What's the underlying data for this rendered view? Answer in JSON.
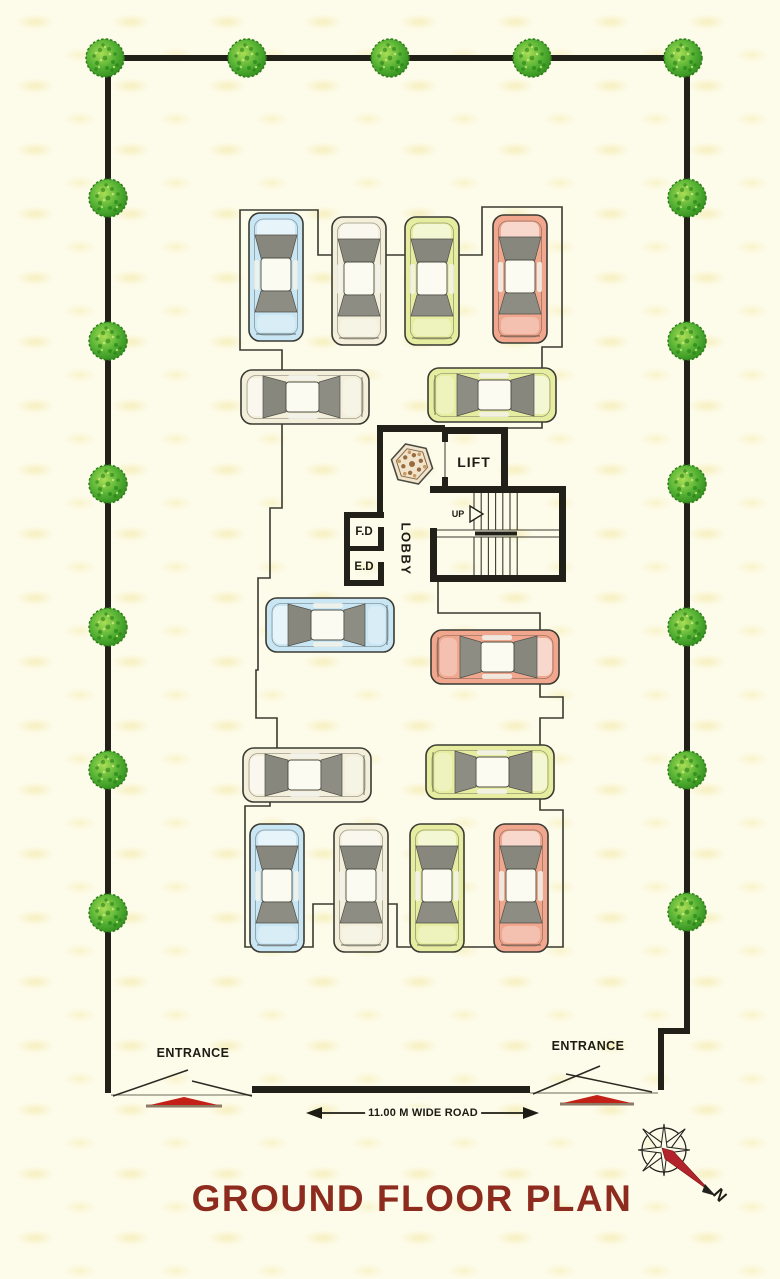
{
  "title": {
    "text": "GROUND FLOOR PLAN",
    "color": "#8e2b1f"
  },
  "core": {
    "lift_label": "LIFT",
    "lobby_label": "LOBBY",
    "fire_duct_label": "F.D",
    "electrical_duct_label": "E.D",
    "stairs_up_label": "UP"
  },
  "entrances": {
    "left_label": "ENTRANCE",
    "right_label": "ENTRANCE"
  },
  "road": {
    "dimension_label": "11.00 M WIDE ROAD"
  },
  "compass": {
    "north_label": "N"
  },
  "colors": {
    "background": "#fdfbe9",
    "boundary_wall": "#21211a",
    "outline": "#3a3a30",
    "title_text": "#8e2b1f",
    "tree_dark": "#2f8a1c",
    "tree_light": "#9fd94e",
    "gate_bump_red": "#c32017",
    "compass_needle_red": "#b3232b",
    "car_blue": "#c9e6f4",
    "car_cream": "#f3efda",
    "car_yellow": "#e7eda0",
    "car_red": "#f0a78e"
  },
  "boundary": {
    "top_y": 58,
    "left_x": 108,
    "right_x": 687,
    "front_y": 1090
  },
  "trees": {
    "top_wall_y": 58,
    "left_wall_x": 108,
    "right_wall_x": 687,
    "top_wall_x": [
      105,
      247,
      390,
      532,
      683
    ],
    "left_wall_y": [
      198,
      341,
      484,
      627,
      770,
      913
    ],
    "right_wall_y": [
      198,
      341,
      484,
      627,
      770,
      912
    ]
  },
  "cars": [
    {
      "id": "car-top-1",
      "color": "blue",
      "orient": "up",
      "cx": 276,
      "cy": 277
    },
    {
      "id": "car-top-2",
      "color": "cream",
      "orient": "up",
      "cx": 359,
      "cy": 281
    },
    {
      "id": "car-top-3",
      "color": "yellow",
      "orient": "up",
      "cx": 432,
      "cy": 281
    },
    {
      "id": "car-top-4",
      "color": "red",
      "orient": "up",
      "cx": 520,
      "cy": 279
    },
    {
      "id": "car-row2-1",
      "color": "cream",
      "orient": "left",
      "cx": 305,
      "cy": 397
    },
    {
      "id": "car-row2-2",
      "color": "yellow",
      "orient": "right",
      "cx": 492,
      "cy": 395
    },
    {
      "id": "car-mid-1",
      "color": "blue",
      "orient": "left",
      "cx": 330,
      "cy": 625
    },
    {
      "id": "car-mid-2",
      "color": "red",
      "orient": "right",
      "cx": 495,
      "cy": 657
    },
    {
      "id": "car-row4-1",
      "color": "cream",
      "orient": "left",
      "cx": 307,
      "cy": 775
    },
    {
      "id": "car-row4-2",
      "color": "yellow",
      "orient": "right",
      "cx": 490,
      "cy": 772
    },
    {
      "id": "car-bottom-1",
      "color": "blue",
      "orient": "up",
      "cx": 277,
      "cy": 888
    },
    {
      "id": "car-bottom-2",
      "color": "cream",
      "orient": "up",
      "cx": 361,
      "cy": 888
    },
    {
      "id": "car-bottom-3",
      "color": "yellow",
      "orient": "up",
      "cx": 437,
      "cy": 888
    },
    {
      "id": "car-bottom-4",
      "color": "red",
      "orient": "up",
      "cx": 521,
      "cy": 888
    }
  ]
}
